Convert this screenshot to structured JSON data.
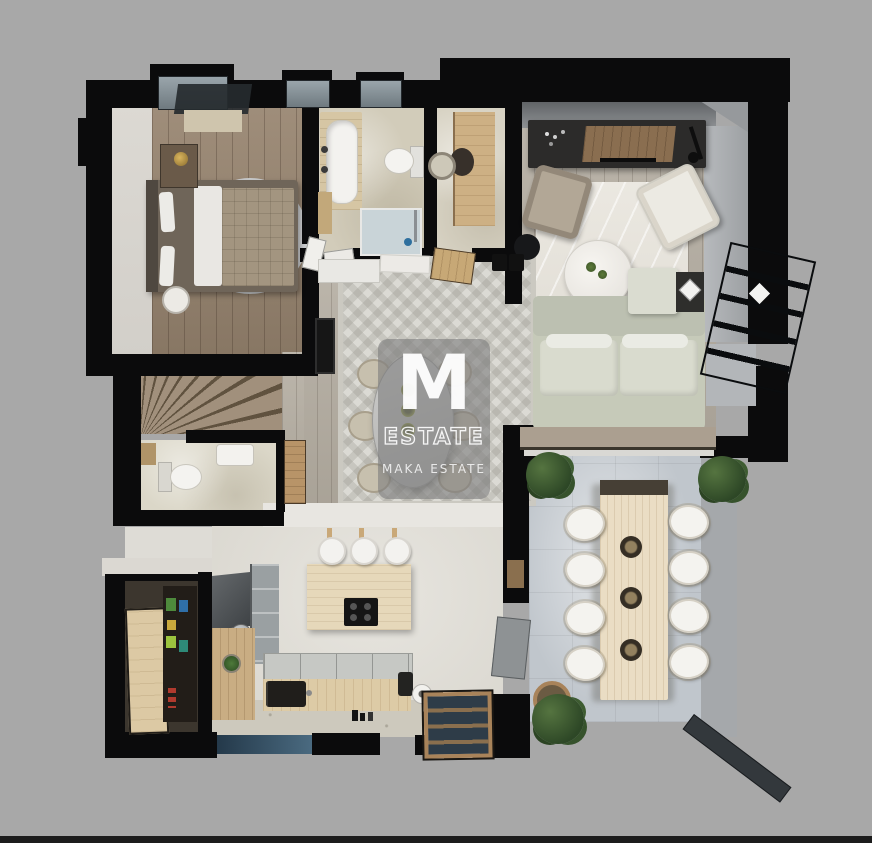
{
  "scene": {
    "type": "3d-floor-plan-top-view-render",
    "background": "#a8a8a8"
  },
  "watermark": {
    "monogram": "M",
    "title": "ESTATE",
    "subtitle": "MAKA ESTATE"
  },
  "palette": {
    "walls": "#0b0b0c",
    "wood_warm": "#97846f",
    "wood_gray": "#b3aca0",
    "stone_beige": "#d2ccba",
    "marble_rug": "#e7e4dd",
    "concrete_terrace": "#c0c6cc",
    "sofa_sage": "#c6cab9",
    "window_glass": "#8e9aa2",
    "bottom_window": "#24394a",
    "plant_green": "#3c5a33",
    "table_wood": "#eaddc4",
    "watermark_gray": "rgba(126,126,126,0.62)"
  },
  "rooms": [
    "bedroom",
    "bathroom",
    "laundry-room",
    "living-room",
    "hall-dining",
    "staircase",
    "wc",
    "pantry",
    "kitchen",
    "entrance",
    "terrace-dining"
  ]
}
